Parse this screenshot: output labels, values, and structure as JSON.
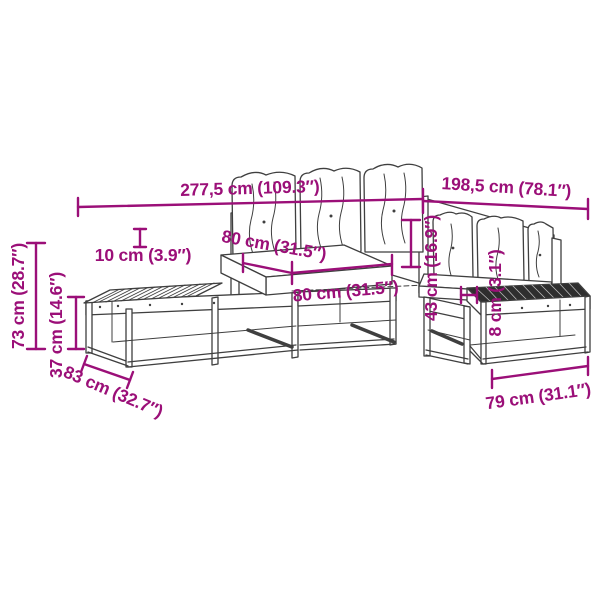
{
  "diagram": {
    "type": "furniture-dimension-diagram",
    "subject": "5-piece wooden garden lounge set with cushions and side tables",
    "colors": {
      "dimension_accent": "#9b0f78",
      "line_art": "#3f3f3f",
      "background": "#ffffff",
      "dark_tabletop": "#2e2e2e"
    },
    "labels": {
      "total_length": "277,5 cm (109.3″)",
      "right_section_length": "198,5 cm (78.1″)",
      "height_total": "73 cm (28.7″)",
      "height_table": "37 cm (14.6″)",
      "back_offset": "10 cm (3.9″)",
      "back_module_width": "80 cm (31.5″)",
      "seat_module_width": "80 cm (31.5″)",
      "seat_height": "43 cm (16.9″)",
      "gap_small": "8 cm (3.1″)",
      "left_table_depth": "83 cm (32.7″)",
      "right_table_depth": "79 cm (31.1″)"
    }
  }
}
